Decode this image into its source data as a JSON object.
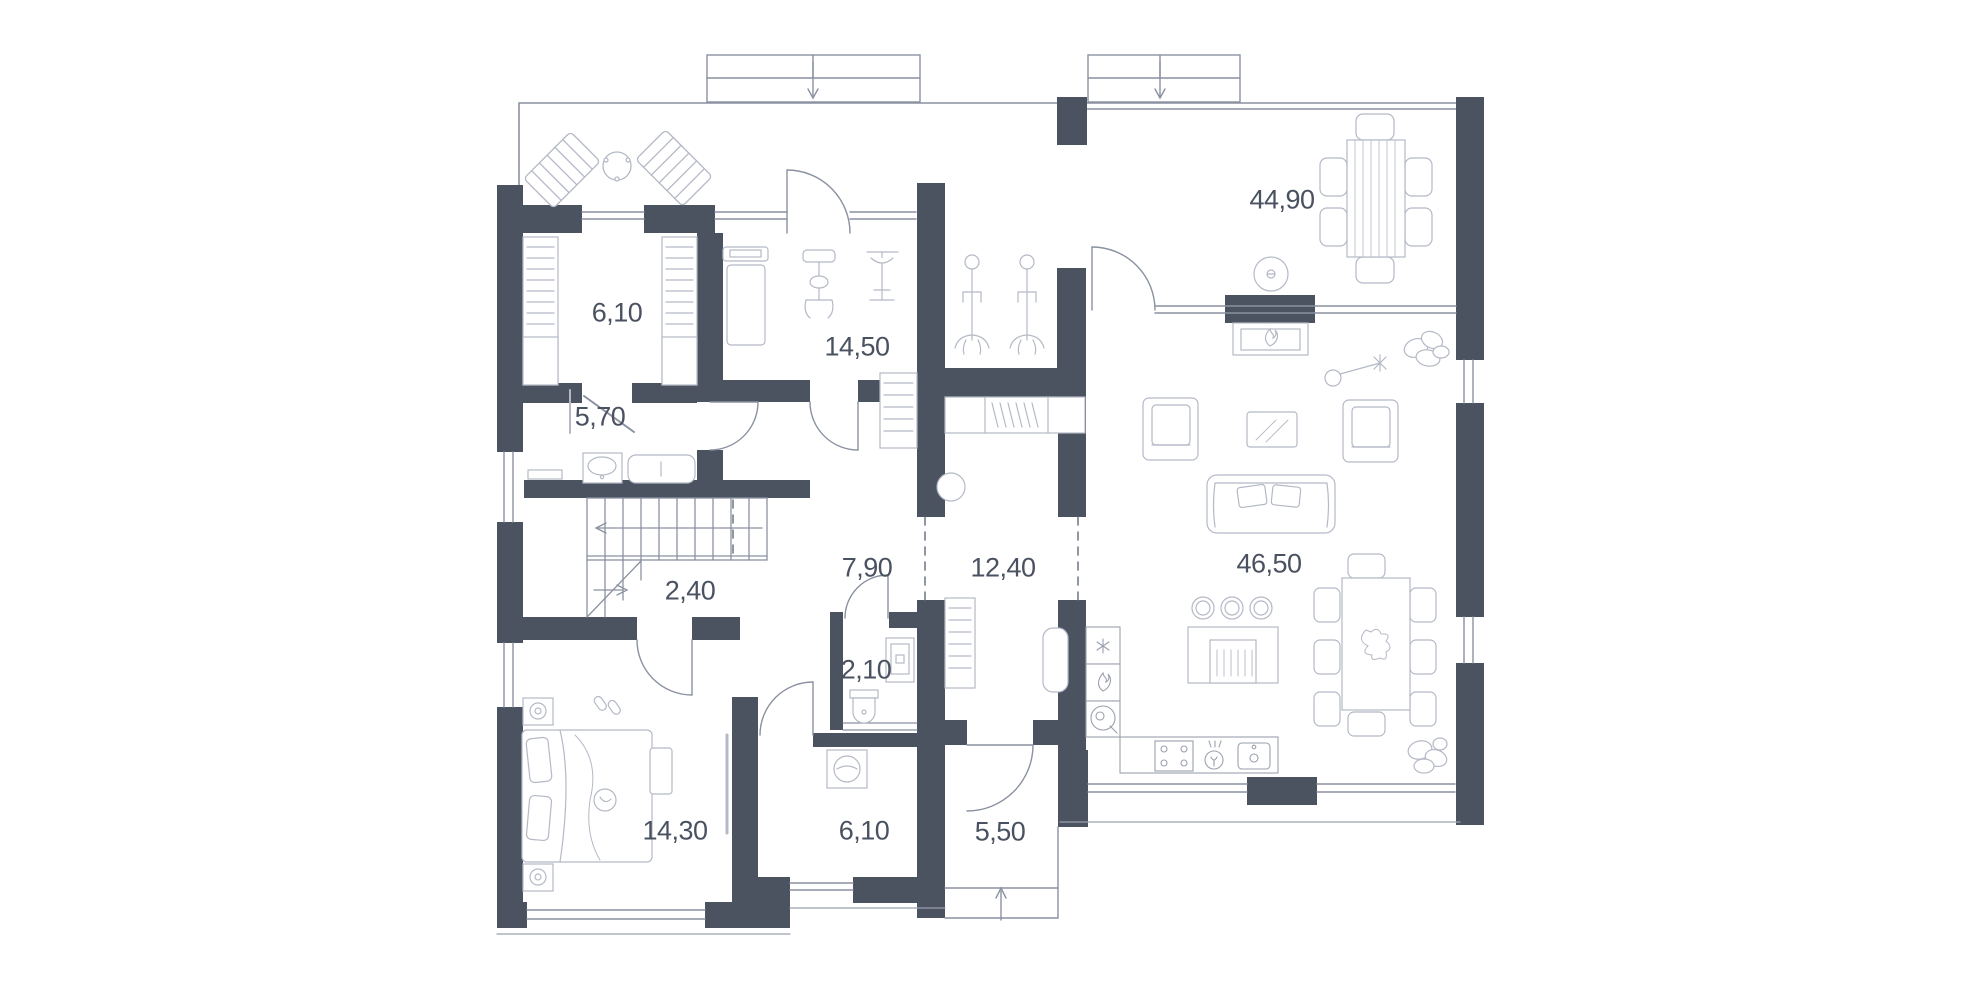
{
  "title": "floor-plan",
  "rooms": [
    {
      "id": "wardrobe",
      "area": "6,10",
      "x": 617,
      "y": 313
    },
    {
      "id": "bathroom",
      "area": "5,70",
      "x": 600,
      "y": 417
    },
    {
      "id": "gym",
      "area": "14,50",
      "x": 857,
      "y": 347
    },
    {
      "id": "dining-living",
      "area": "44,90",
      "x": 1282,
      "y": 200
    },
    {
      "id": "stairs-area",
      "area": "2,40",
      "x": 690,
      "y": 591
    },
    {
      "id": "hall",
      "area": "7,90",
      "x": 867,
      "y": 568
    },
    {
      "id": "corridor",
      "area": "12,40",
      "x": 1003,
      "y": 568
    },
    {
      "id": "kitchen-living",
      "area": "46,50",
      "x": 1269,
      "y": 564
    },
    {
      "id": "wc",
      "area": "2,10",
      "x": 866,
      "y": 670
    },
    {
      "id": "bedroom",
      "area": "14,30",
      "x": 675,
      "y": 831
    },
    {
      "id": "laundry",
      "area": "6,10",
      "x": 864,
      "y": 831
    },
    {
      "id": "entry",
      "area": "5,50",
      "x": 1000,
      "y": 832
    }
  ],
  "colors": {
    "wall": "#4b5260",
    "structure_line": "#8a91a0",
    "furniture_line": "#b4b9c5",
    "label_text": "#4a5160",
    "background": "#ffffff"
  }
}
